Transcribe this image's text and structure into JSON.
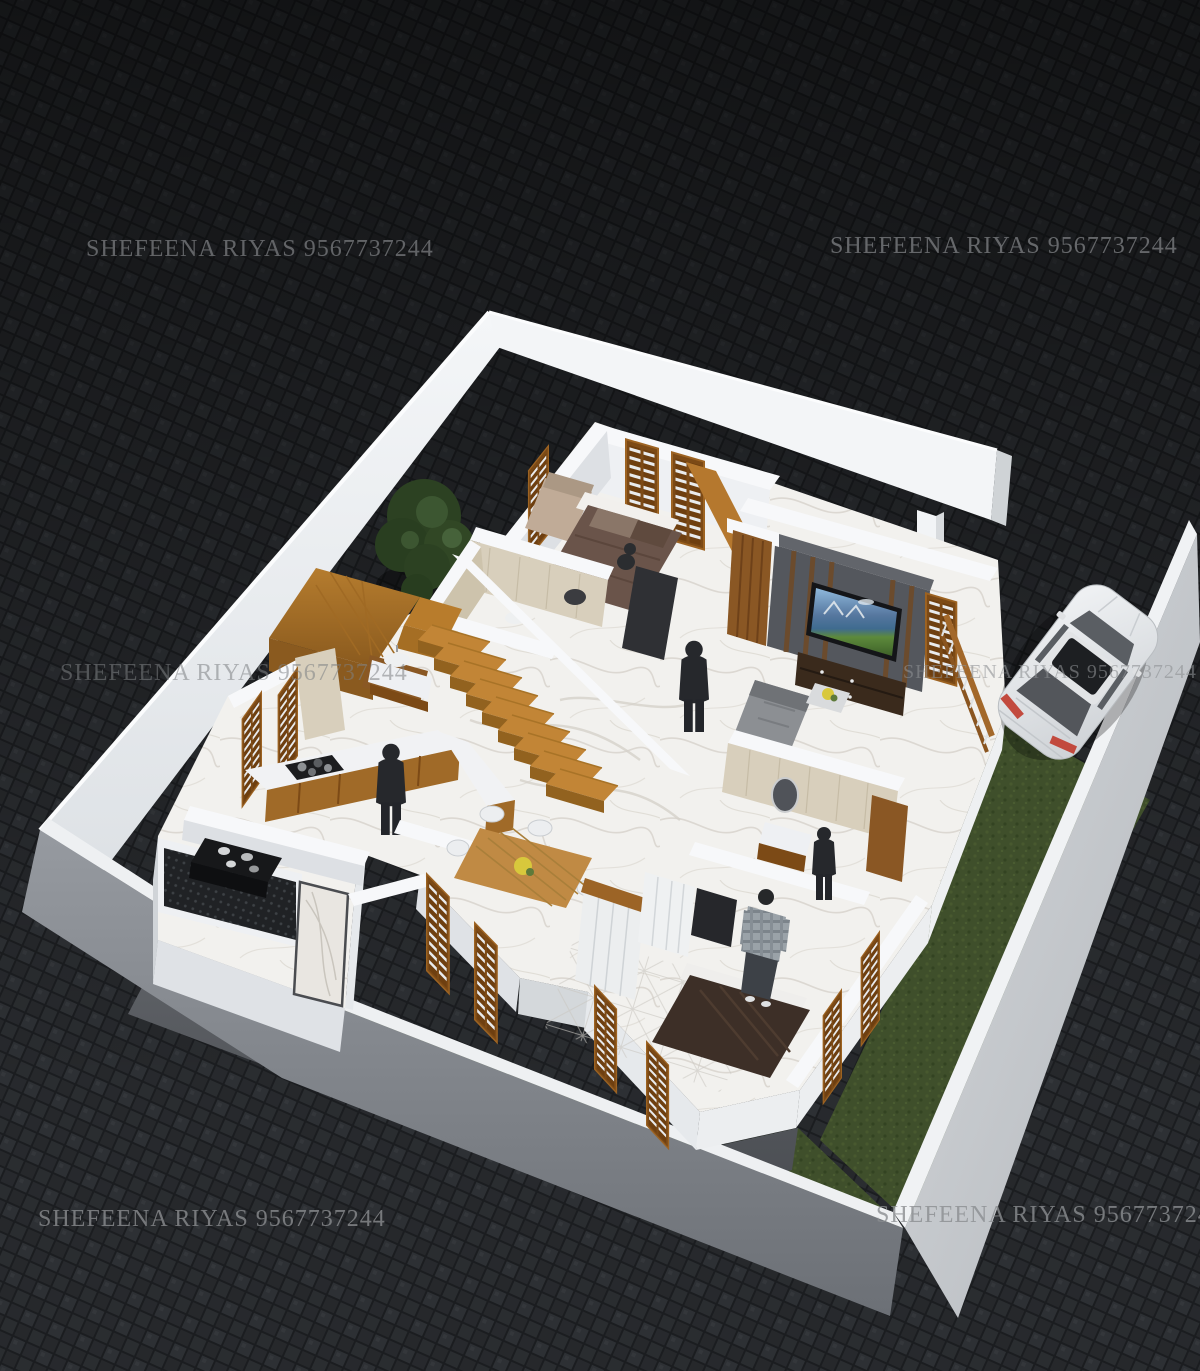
{
  "watermark": {
    "text": "SHEFEENA RIYAS 9567737244"
  },
  "palette": {
    "paving_base": "#26282b",
    "paving_gap": "#1b1d20",
    "compound_wall_lit": "#eef0f2",
    "compound_wall_shadow": "#6f7377",
    "house_wall_white": "#f7f8fa",
    "marble_floor": "#f2f1ee",
    "grass_green": "#3f4f2b",
    "walkway_concrete": "#55585c",
    "wood_frame": "#a0661f",
    "stair_wood": "#c28536",
    "tv_accent_wall": "#54575d",
    "tv_cabinet": "#3a2a1c",
    "bathroom_tile_beige": "#d8cfbc",
    "work_area_mesh": "#202225",
    "car_body_white": "#eef0f2",
    "taillight_red": "#c24a3e",
    "flower_yellow": "#d8c83c",
    "bed1_blanket": "#6a544a",
    "bed2_blanket": "#3d2f27",
    "shrub_green": "#2c4122"
  },
  "scene": {
    "type": "3d-floor-plan-render",
    "view": "isometric-aerial",
    "objects": [
      "paving-ground",
      "compound-wall",
      "gate-pillar",
      "shrubs",
      "grass-lawn",
      "concrete-walkway",
      "house-plinth",
      "marble-floor",
      "staircase",
      "landing",
      "master-bedroom-bed",
      "bedroom-sofa",
      "louver-windows",
      "wooden-beam",
      "attached-bathroom",
      "tv-accent-wall",
      "television",
      "tv-cabinet",
      "wooden-door",
      "living-sofa",
      "coffee-table",
      "flower-vase",
      "sitout-railing",
      "kitchen-counter",
      "cooktop",
      "kitchen-person",
      "work-area-mesh",
      "work-counter-pots",
      "marble-door",
      "dining-table",
      "dining-chairs",
      "wardrobe",
      "second-bathroom-vanity",
      "oval-mirror",
      "second-bedroom-bed",
      "plaid-shirt-person",
      "foyer-person",
      "bathroom-person",
      "white-sedan-car"
    ]
  }
}
